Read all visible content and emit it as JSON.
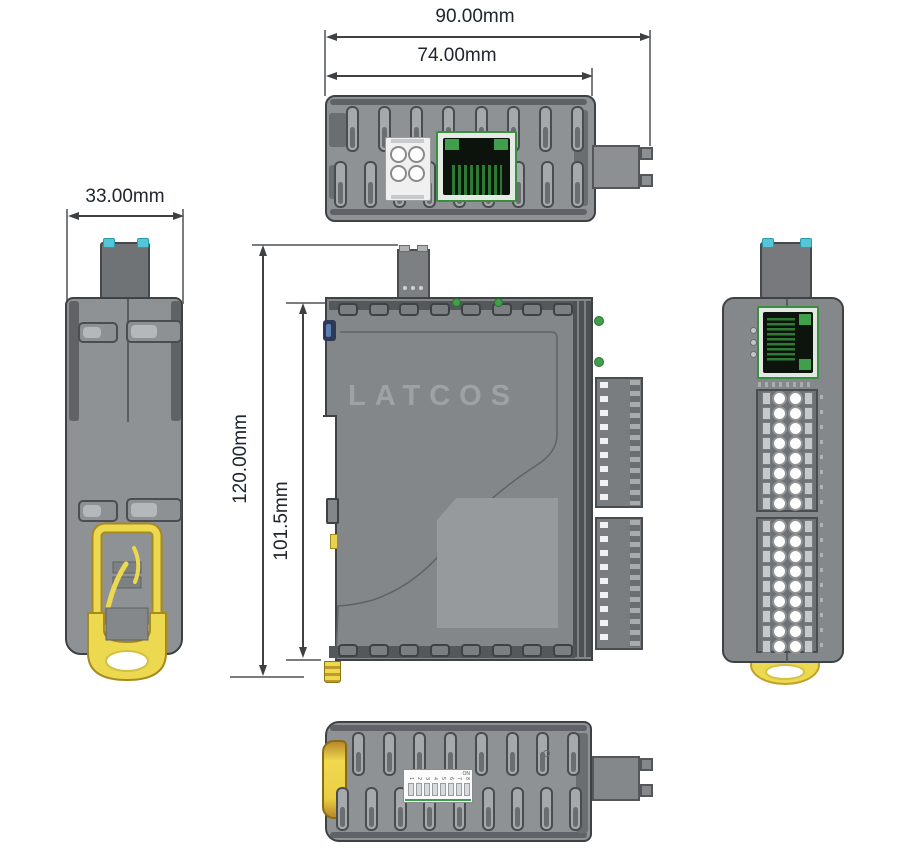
{
  "product": {
    "brand_logo": "LATCOS"
  },
  "dimensions": {
    "overall_width": "90.00mm",
    "module_width": "74.00mm",
    "side_depth": "33.00mm",
    "overall_height": "120.00mm",
    "module_height": "101.5mm"
  },
  "dip_switch": {
    "on_label": "ON",
    "positions": [
      "1",
      "2",
      "3",
      "4",
      "5",
      "6",
      "7",
      "8"
    ]
  },
  "colors": {
    "body_gray": "#8f9295",
    "outline": "#3f4245",
    "accent_yellow": "#ecd94f",
    "accent_cyan": "#55c6d7",
    "rj45_green": "#3f9f4a",
    "dim_text": "#20262e"
  }
}
